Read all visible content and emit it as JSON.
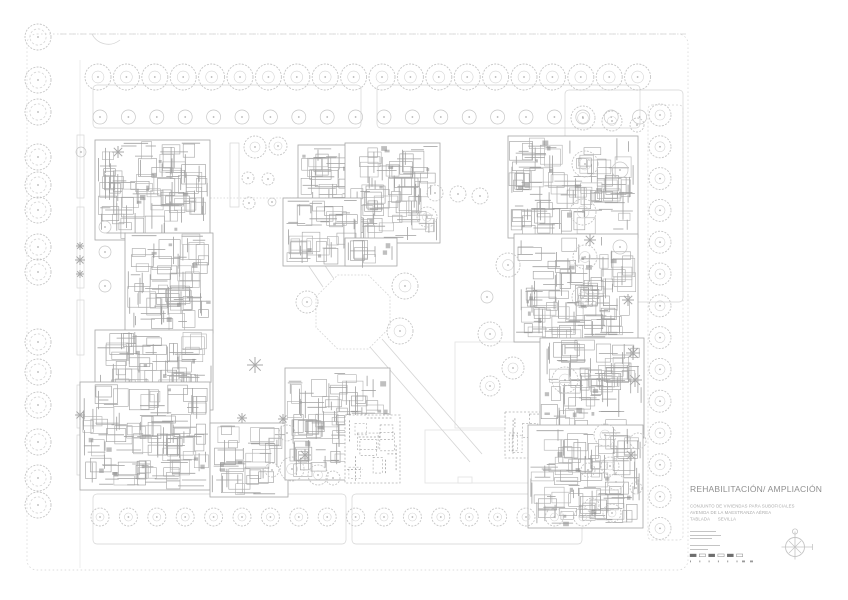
{
  "title_block": {
    "title": "REHABILITACIÓN/ AMPLIACIÓN",
    "project_lines": [
      "CONJUNTO DE VIVIENDAS PARA SUBOFICIALES",
      "AVENIDA DE LA MAESTRANZA AÉREA",
      "TABLADA      SEVILLA"
    ]
  },
  "colors": {
    "bg": "#ffffff",
    "line_faint": "#e2e2e2",
    "line_light": "#d4d4d4",
    "tree": "#c6c6c6",
    "tree_dark": "#b2b2b2",
    "wall": "#a6a6a6",
    "wall_dark": "#8a8a8a",
    "star": "#a9a9a9",
    "title_text": "#8f8f8f",
    "sub_text": "#a9a9a9",
    "scale_dark": "#6e6e6e",
    "compass": "#c4c4c4"
  },
  "site_plan": {
    "boundary": {
      "x": 27,
      "y": 34,
      "w": 661,
      "h": 536
    },
    "road_top": [
      60,
      34,
      688,
      34
    ],
    "road_arc": "M 92 34 c 5 10 18 14 28 6",
    "beds": [
      [
        93,
        85,
        268,
        43,
        0
      ],
      [
        377,
        85,
        263,
        43,
        0
      ],
      [
        565,
        90,
        118,
        212,
        0
      ],
      [
        93,
        494,
        253,
        50,
        0
      ],
      [
        352,
        494,
        230,
        50,
        0
      ],
      [
        648,
        105,
        35,
        435,
        1
      ]
    ],
    "hedges": [
      [
        77,
        135,
        7,
        63
      ],
      [
        77,
        207,
        7,
        81
      ],
      [
        77,
        300,
        7,
        55
      ],
      [
        77,
        385,
        7,
        43
      ],
      [
        77,
        435,
        7,
        40
      ],
      [
        230,
        143,
        9,
        64
      ]
    ],
    "panels": [
      [
        455,
        342,
        124,
        86
      ],
      [
        425,
        430,
        120,
        53
      ]
    ],
    "panel_notch": [
      458,
      477,
      14,
      6
    ],
    "paths": [
      [
        283,
        228,
        323,
        287,
        0
      ],
      [
        295,
        221,
        334,
        279,
        0
      ],
      [
        370,
        347,
        470,
        462,
        0
      ],
      [
        382,
        339,
        482,
        454,
        0
      ],
      [
        207,
        198,
        300,
        198,
        1
      ]
    ],
    "octagon": {
      "cx": 353,
      "cy": 312,
      "r": 40
    },
    "buildings": [
      [
        95,
        140,
        115,
        100,
        1,
        0
      ],
      [
        298,
        145,
        60,
        92,
        0.9,
        0
      ],
      [
        345,
        143,
        95,
        100,
        1,
        0
      ],
      [
        283,
        198,
        78,
        68,
        0.9,
        0
      ],
      [
        345,
        238,
        52,
        28,
        0.8,
        0
      ],
      [
        125,
        233,
        88,
        100,
        1,
        0
      ],
      [
        95,
        330,
        118,
        80,
        0.95,
        0
      ],
      [
        80,
        382,
        130,
        108,
        1,
        0
      ],
      [
        210,
        423,
        78,
        74,
        0.85,
        0
      ],
      [
        285,
        368,
        105,
        112,
        0.95,
        0
      ],
      [
        345,
        415,
        55,
        68,
        0.5,
        1
      ],
      [
        505,
        412,
        50,
        46,
        0.5,
        1
      ],
      [
        508,
        136,
        130,
        102,
        1,
        0
      ],
      [
        514,
        234,
        124,
        108,
        1,
        0
      ],
      [
        540,
        338,
        104,
        100,
        0.95,
        0
      ],
      [
        528,
        425,
        115,
        103,
        1,
        0
      ]
    ],
    "tree_rows": [
      {
        "x0": 98,
        "y": 77,
        "dx": 28.4,
        "n": 20,
        "r": 13,
        "t": "sc"
      },
      {
        "x0": 100,
        "y": 117,
        "dx": 28.4,
        "n": 20,
        "r": 7,
        "t": "ri"
      },
      {
        "x0": 100,
        "y": 517,
        "dx": 28.4,
        "n": 18,
        "r": 9,
        "t": "sc"
      }
    ],
    "tree_cols": [
      {
        "y0": 115,
        "x": 660,
        "dy": 31.8,
        "n": 14,
        "r": 11,
        "t": "sc"
      }
    ],
    "left_column": {
      "x": 38,
      "r": 13,
      "ys": [
        37,
        80,
        112,
        157,
        185,
        210,
        247,
        272,
        342,
        372,
        405,
        442,
        478,
        505
      ]
    },
    "trees": [
      [
        255,
        147,
        11,
        "sc"
      ],
      [
        278,
        146,
        9,
        "sc"
      ],
      [
        248,
        178,
        6,
        "sc"
      ],
      [
        268,
        179,
        6,
        "sc"
      ],
      [
        249,
        203,
        6,
        "sc"
      ],
      [
        272,
        202,
        4,
        "ri"
      ],
      [
        105,
        227,
        6,
        "ri"
      ],
      [
        105,
        252,
        6,
        "ri"
      ],
      [
        105,
        286,
        6,
        "ri"
      ],
      [
        81,
        152,
        5,
        "ri"
      ],
      [
        307,
        302,
        11,
        "sc"
      ],
      [
        405,
        286,
        13,
        "sc"
      ],
      [
        400,
        331,
        13,
        "sc"
      ],
      [
        427,
        217,
        10,
        "sc"
      ],
      [
        435,
        193,
        8,
        "sc"
      ],
      [
        458,
        194,
        8,
        "sc"
      ],
      [
        480,
        196,
        8,
        "sc"
      ],
      [
        583,
        118,
        12,
        "sc"
      ],
      [
        612,
        121,
        10,
        "sc"
      ],
      [
        637,
        125,
        7,
        "sc"
      ],
      [
        585,
        164,
        13,
        "sc"
      ],
      [
        620,
        170,
        8,
        "ri"
      ],
      [
        583,
        212,
        13,
        "sc"
      ],
      [
        585,
        257,
        12,
        "sc"
      ],
      [
        620,
        247,
        7,
        "ri"
      ],
      [
        583,
        297,
        11,
        "sc"
      ],
      [
        508,
        265,
        12,
        "sc"
      ],
      [
        490,
        334,
        12,
        "sc"
      ],
      [
        513,
        368,
        11,
        "sc"
      ],
      [
        490,
        386,
        10,
        "sc"
      ],
      [
        565,
        380,
        13,
        "sc"
      ],
      [
        487,
        297,
        6,
        "ri"
      ],
      [
        287,
        433,
        8,
        "sc"
      ],
      [
        292,
        469,
        12,
        "sc"
      ],
      [
        318,
        475,
        10,
        "sc"
      ],
      [
        333,
        478,
        7,
        "sc"
      ],
      [
        272,
        470,
        7,
        "sc"
      ],
      [
        605,
        435,
        11,
        "sc"
      ],
      [
        638,
        441,
        8,
        "sc"
      ],
      [
        610,
        466,
        9,
        "sc"
      ],
      [
        588,
        470,
        7,
        "sc"
      ],
      [
        616,
        482,
        8,
        "sc"
      ],
      [
        636,
        488,
        6,
        "sc"
      ],
      [
        592,
        505,
        7,
        "sc"
      ],
      [
        612,
        513,
        9,
        "sc"
      ]
    ],
    "conifers": [
      [
        118,
        152,
        6
      ],
      [
        80,
        246,
        4
      ],
      [
        80,
        260,
        5
      ],
      [
        80,
        274,
        4
      ],
      [
        80,
        415,
        5
      ],
      [
        255,
        365,
        8
      ],
      [
        590,
        240,
        6
      ],
      [
        628,
        300,
        6
      ],
      [
        633,
        353,
        7
      ],
      [
        635,
        380,
        7
      ],
      [
        631,
        455,
        6
      ],
      [
        305,
        455,
        6
      ],
      [
        283,
        419,
        5
      ],
      [
        242,
        418,
        5
      ]
    ],
    "scale_bar": {
      "x": 690,
      "y": 554,
      "segments": 6,
      "seg_w": 6.2,
      "gap": 3.1
    },
    "compass": {
      "cx": 795,
      "cy": 547,
      "r": 9.5
    }
  }
}
